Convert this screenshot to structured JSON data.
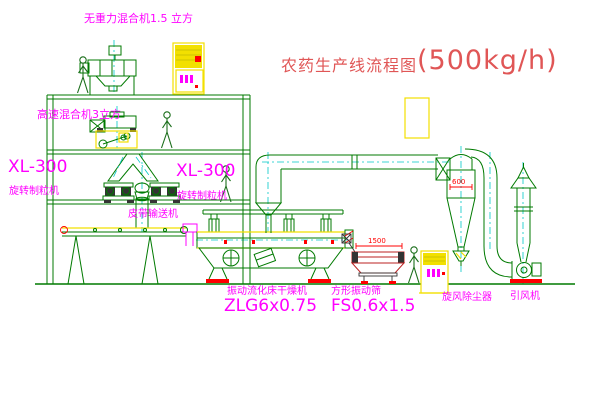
{
  "title": {
    "name": "农药生产线流程图",
    "capacity": "(500kg/h)"
  },
  "equipment_labels": {
    "gravity_mixer": "无重力混合机1.5 立方",
    "high_speed_mixer": "高速混合机3立方",
    "granulator_left_model": "XL-300",
    "granulator_left_name": "旋转制粒机",
    "granulator_right_model": "XL-300",
    "granulator_right_name": "旋转制粒机",
    "belt_conveyor": "皮带输送机",
    "fluid_bed_dryer_name": "振动流化床干燥机",
    "fluid_bed_dryer_model": "ZLG6x0.75",
    "vibrating_sieve_name": "方形振动筛",
    "vibrating_sieve_model": "FS0.6x1.5",
    "cyclone_name": "旋风除尘器",
    "fan_name": "引风机"
  },
  "dimensions": {
    "sieve_width": "1500",
    "cyclone_diameter": "600"
  },
  "colors": {
    "bg": "#ffffff",
    "line-green": "#007a00",
    "centerline-cyan": "#00c8c8",
    "label-magenta": "#ff00ff",
    "accent-yellow": "#f2e000",
    "accent-red": "#ff0000",
    "title-red": "#e05656",
    "dark": "#333333"
  }
}
